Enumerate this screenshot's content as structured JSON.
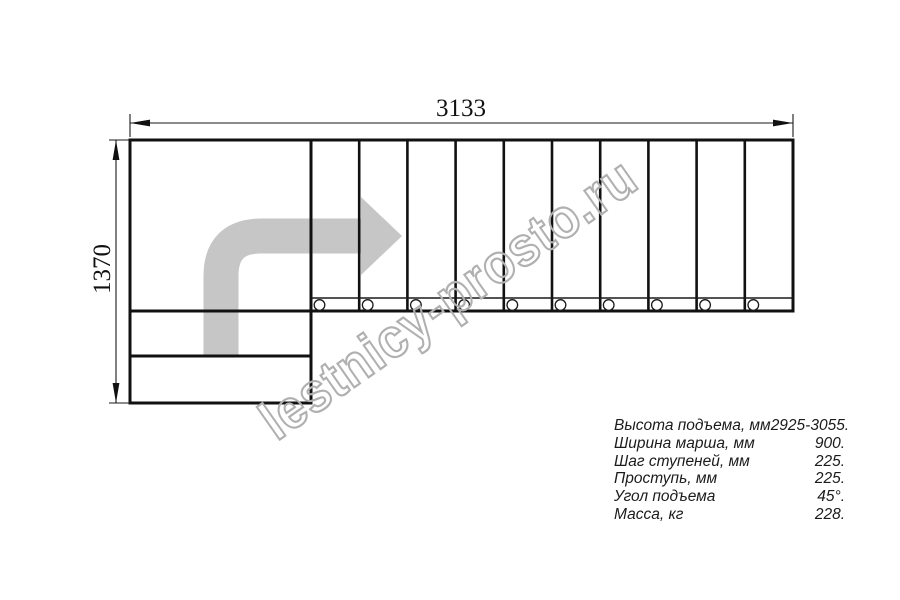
{
  "dimensions": {
    "total_run": "3133",
    "total_width": "1370"
  },
  "watermark": {
    "text": "lestnicy-prosto.ru"
  },
  "specs": {
    "rows": [
      {
        "label": "Высота подъема, мм",
        "value": "2925-3055."
      },
      {
        "label": "Ширина марша, мм",
        "value": "900."
      },
      {
        "label": "Шаг ступеней, мм",
        "value": "225."
      },
      {
        "label": "Проступь, мм",
        "value": "225."
      },
      {
        "label": "Угол подъема",
        "value": "45°."
      },
      {
        "label": "Масса, кг",
        "value": "228."
      }
    ]
  },
  "colors": {
    "line": "#111111",
    "thin_line": "#1a1a1a",
    "direction_arrow": "#c6c6c6",
    "watermark": "#b0b0b0"
  }
}
